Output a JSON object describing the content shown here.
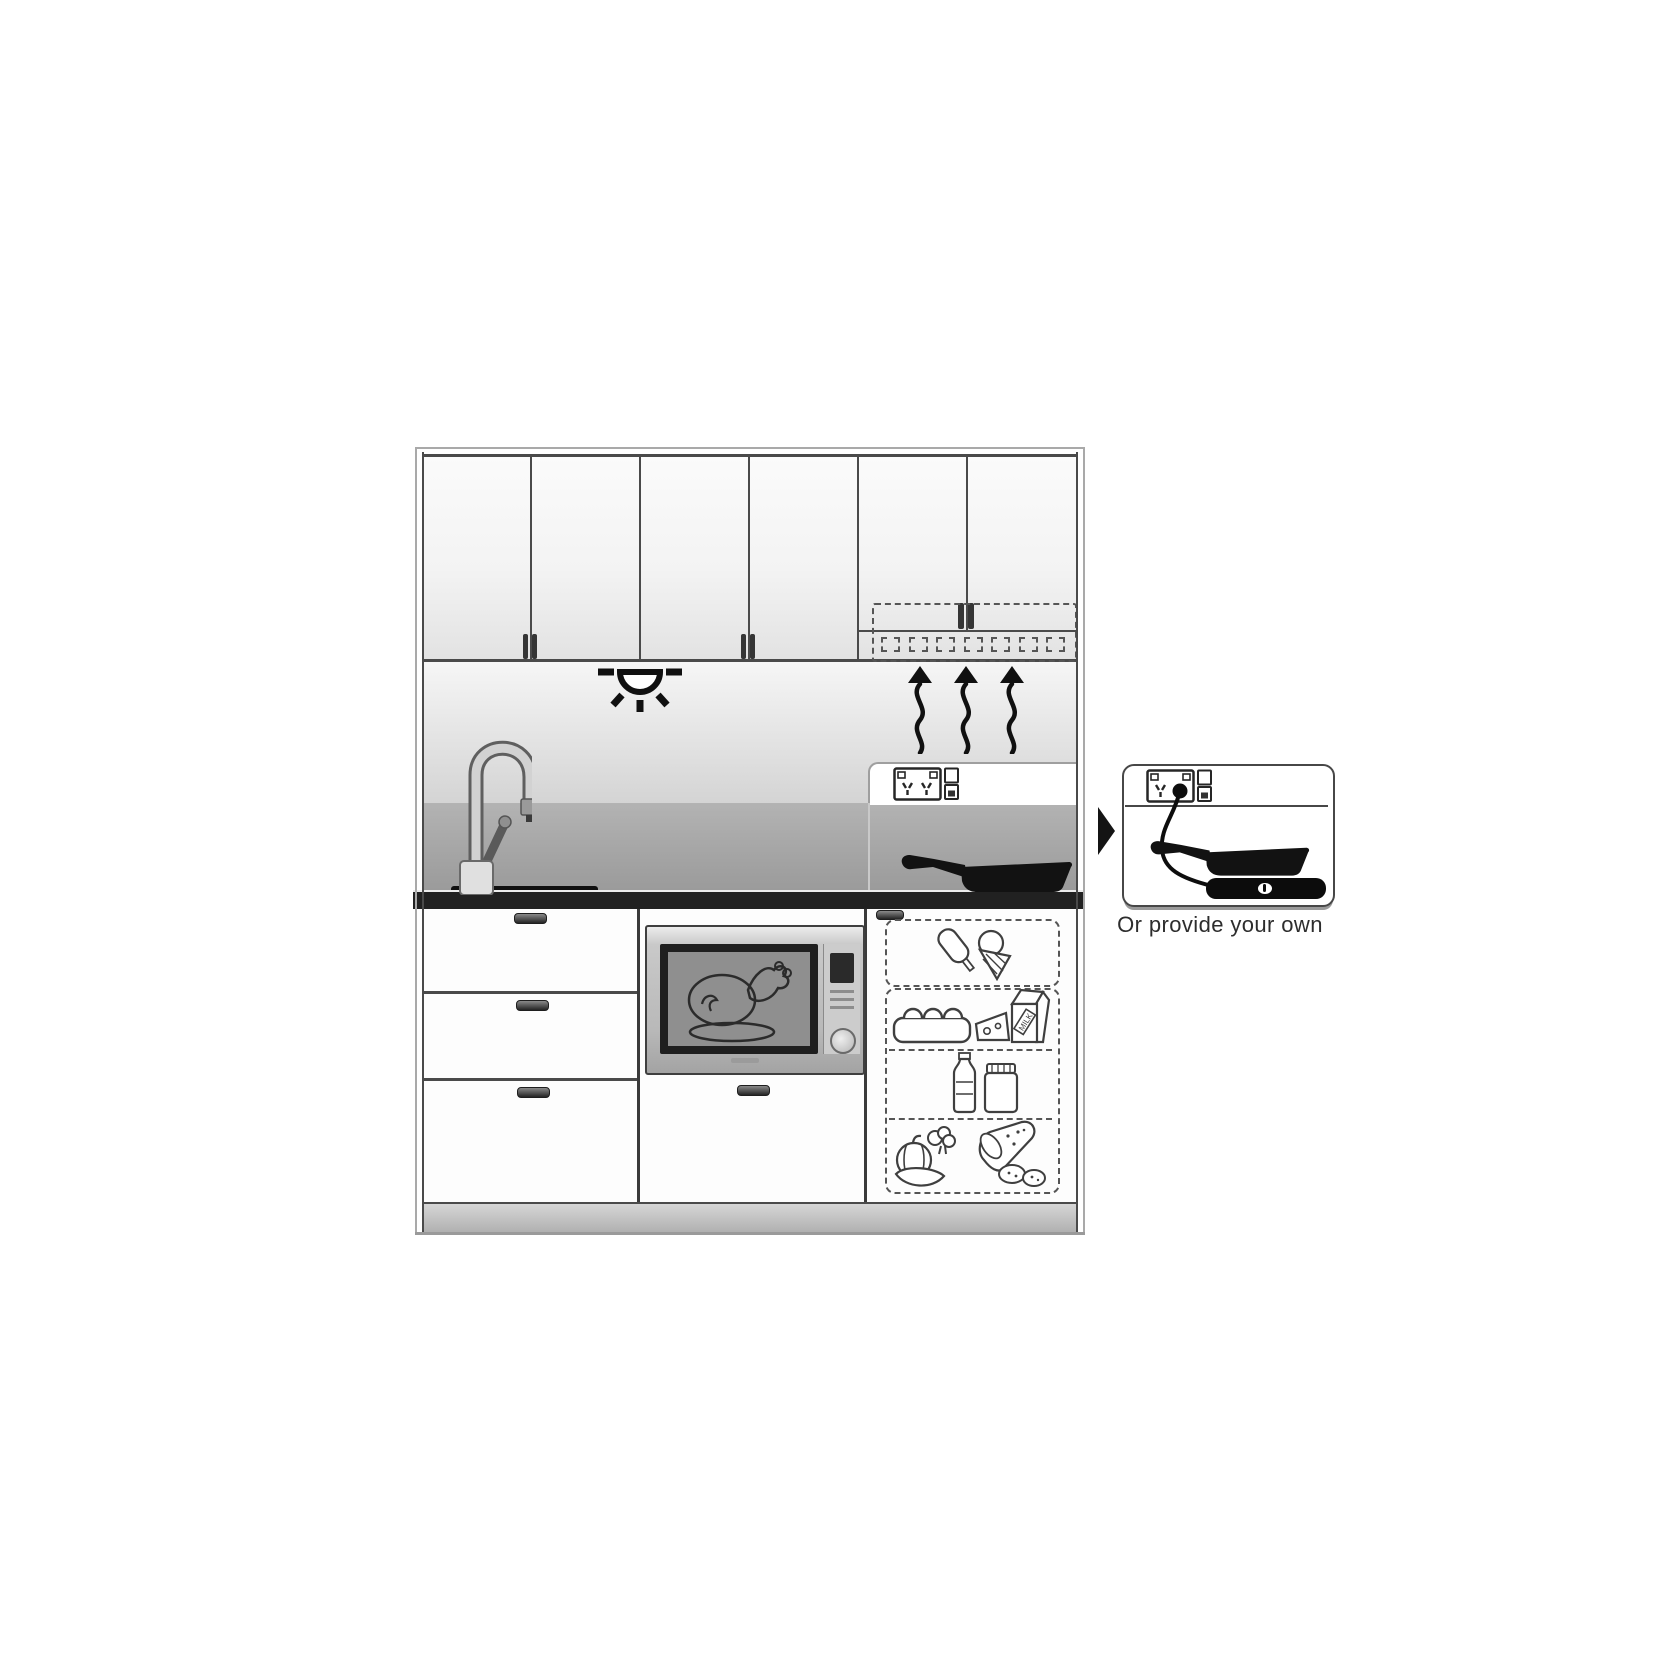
{
  "figure": {
    "caption": "Or provide your own",
    "milk_label": "MILK",
    "colors": {
      "line": "#4a4a4a",
      "ink": "#111111",
      "backsplash_light": "#e8e8e8",
      "backsplash_dark": "#a0a0a0",
      "countertop": "#212121",
      "steel_light": "#e8e8e8",
      "steel_dark": "#adadad"
    },
    "icons": {
      "ceiling_light": "downlight-with-rays",
      "steam": "three-wavy-up-arrows",
      "power_outlet": "double-power-point-with-switches",
      "tap": "gooseneck-mixer-tap",
      "pan": "frying-pan-silhouette",
      "microwave_food": "roast-chicken-on-plate",
      "freezer_items": "ice-cream-bar-and-cone",
      "fridge_shelf_1": "egg-carton-cheese-milk-carton",
      "fridge_shelf_2": "bottle-and-jar",
      "fridge_shelf_3": "vegetables-and-salami",
      "portable_cooktop": "induction-plate-with-cord",
      "pointer": "right-arrowhead"
    }
  }
}
